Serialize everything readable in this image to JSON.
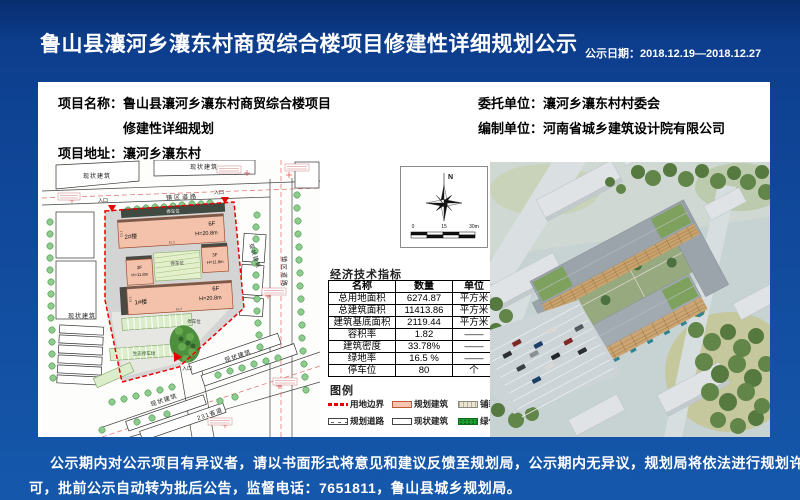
{
  "page": {
    "title": "鲁山县瀼河乡瀼东村商贸综合楼项目修建性详细规划公示",
    "date_label": "公示日期：2018.12.19—2018.12.27",
    "footer_line1": "公示期内对公示项目有异议者，请以书面形式将意见和建议反馈至规划局，公示期内无异议，规划局将依法进行规划许",
    "footer_line2": "可，批前公示自动转为批后公告，监督电话：7651811，鲁山县城乡规划局。"
  },
  "info": {
    "name_label": "项目名称：",
    "name_value_line1": "鲁山县瀼河乡瀼东村商贸综合楼项目",
    "name_value_line2": "修建性详细规划",
    "address_label": "项目地址：",
    "address_value": "瀼河乡瀼东村",
    "client_label": "委托单位：",
    "client_value": "瀼河乡瀼东村村委会",
    "designer_label": "编制单位：",
    "designer_value": "河南省城乡建筑设计院有限公司"
  },
  "indicators": {
    "title": "经济技术指标",
    "columns": [
      "名称",
      "数量",
      "单位"
    ],
    "rows": [
      [
        "总用地面积",
        "6274.87",
        "平方米"
      ],
      [
        "总建筑面积",
        "11413.86",
        "平方米"
      ],
      [
        "建筑基底面积",
        "2119.44",
        "平方米"
      ],
      [
        "容积率",
        "1.82",
        "——"
      ],
      [
        "建筑密度",
        "33.78%",
        "——"
      ],
      [
        "绿地率",
        "16.5 %",
        "——"
      ],
      [
        "停车位",
        "80",
        "个"
      ]
    ]
  },
  "legend": {
    "title": "图例",
    "items": [
      {
        "label": "用地边界"
      },
      {
        "label": "规划建筑"
      },
      {
        "label": "铺装"
      },
      {
        "label": "规划道路"
      },
      {
        "label": "现状建筑"
      },
      {
        "label": "绿化"
      }
    ]
  },
  "map": {
    "existing_building": "现状建筑",
    "town_road": "镇区道路",
    "provincial_road": "231省道",
    "entrance": "入口",
    "parking_space": "停车位",
    "eco_parking": "生态停车场",
    "building_1": "1#楼",
    "building_2": "2#楼",
    "floors_6f": "6F",
    "height_20": "H=20.8m",
    "floors_3f": "3F",
    "height_11": "H=11.8m",
    "dim_61": "61.2",
    "dim_13": "13.1"
  },
  "compass": {
    "north_label": "N",
    "scale_0": "0",
    "scale_15": "15",
    "scale_30": "30m"
  },
  "colors": {
    "background_blue": "#11499c",
    "boundary_red": "#e80000",
    "planned_building_pink": "#f4c2ab",
    "greening": "#1f9a2f"
  }
}
